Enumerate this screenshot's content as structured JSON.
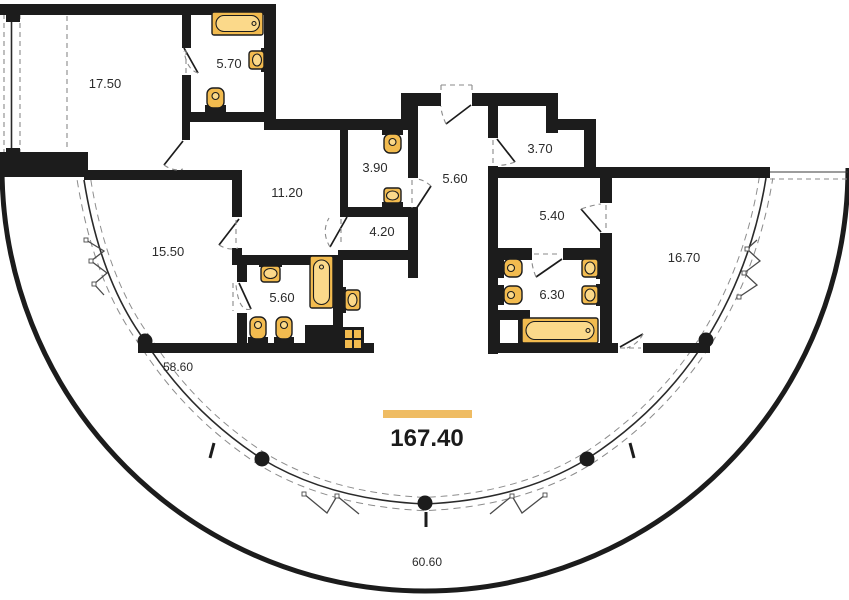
{
  "plan": {
    "total_area": "167.40",
    "rooms": [
      {
        "area": "17.50"
      },
      {
        "area": "5.70"
      },
      {
        "area": "11.20"
      },
      {
        "area": "3.90"
      },
      {
        "area": "5.60"
      },
      {
        "area": "3.70"
      },
      {
        "area": "5.40"
      },
      {
        "area": "4.20"
      },
      {
        "area": "15.50"
      },
      {
        "area": "5.60"
      },
      {
        "area": "6.30"
      },
      {
        "area": "16.70"
      },
      {
        "area": "58.60"
      },
      {
        "area": "60.60"
      }
    ]
  },
  "colors": {
    "wall": "#1c1c1c",
    "fixture": "#F2BB4F",
    "fixture_light": "#FBD98A",
    "accent": "#EFBC63",
    "label": "#2b2b2b",
    "dash": "#8a8a8a",
    "bg": "#ffffff"
  },
  "fixtures": [
    "bathtub",
    "sink",
    "toilet",
    "washing-machine",
    "window-sash",
    "door-swing",
    "column"
  ]
}
